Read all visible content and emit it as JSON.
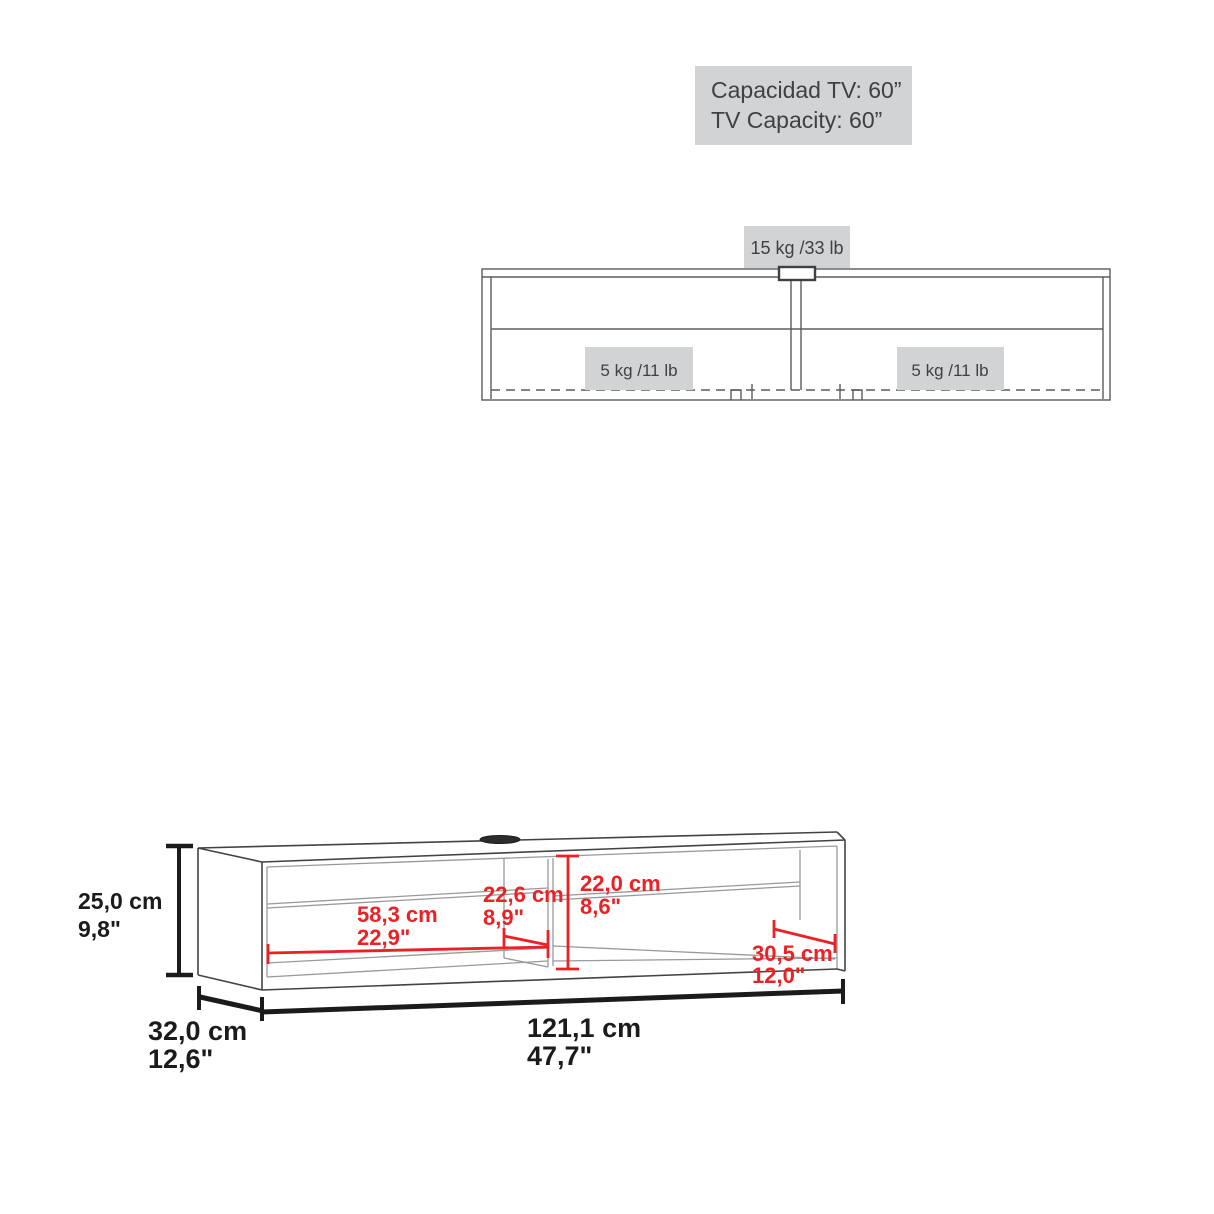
{
  "capacity_label": {
    "line1": "Capacidad TV: 60”",
    "line2": "TV Capacity: 60”"
  },
  "front_view": {
    "top_weight": "15 kg /33 lb",
    "left_shelf_weight": "5 kg /11 lb",
    "right_shelf_weight": "5 kg /11 lb"
  },
  "dimensions": {
    "height_cm": "25,0 cm",
    "height_in": "9,8\"",
    "depth_cm": "32,0 cm",
    "depth_in": "12,6\"",
    "width_cm": "121,1 cm",
    "width_in": "47,7\"",
    "left_compartment_width_cm": "58,3 cm",
    "left_compartment_width_in": "22,9\"",
    "left_compartment_depth_cm": "22,6 cm",
    "left_compartment_depth_in": "8,9\"",
    "compartment_height_cm": "22,0 cm",
    "compartment_height_in": "8,6\"",
    "right_compartment_depth_cm": "30,5 cm",
    "right_compartment_depth_in": "12,0\""
  },
  "colors": {
    "accent_red": "#ed2024",
    "label_background": "#d1d3d4",
    "label_text": "#414042",
    "outline_dark": "#434345",
    "outline_gray": "#97999b",
    "dimension_black": "#1b1b1b"
  }
}
